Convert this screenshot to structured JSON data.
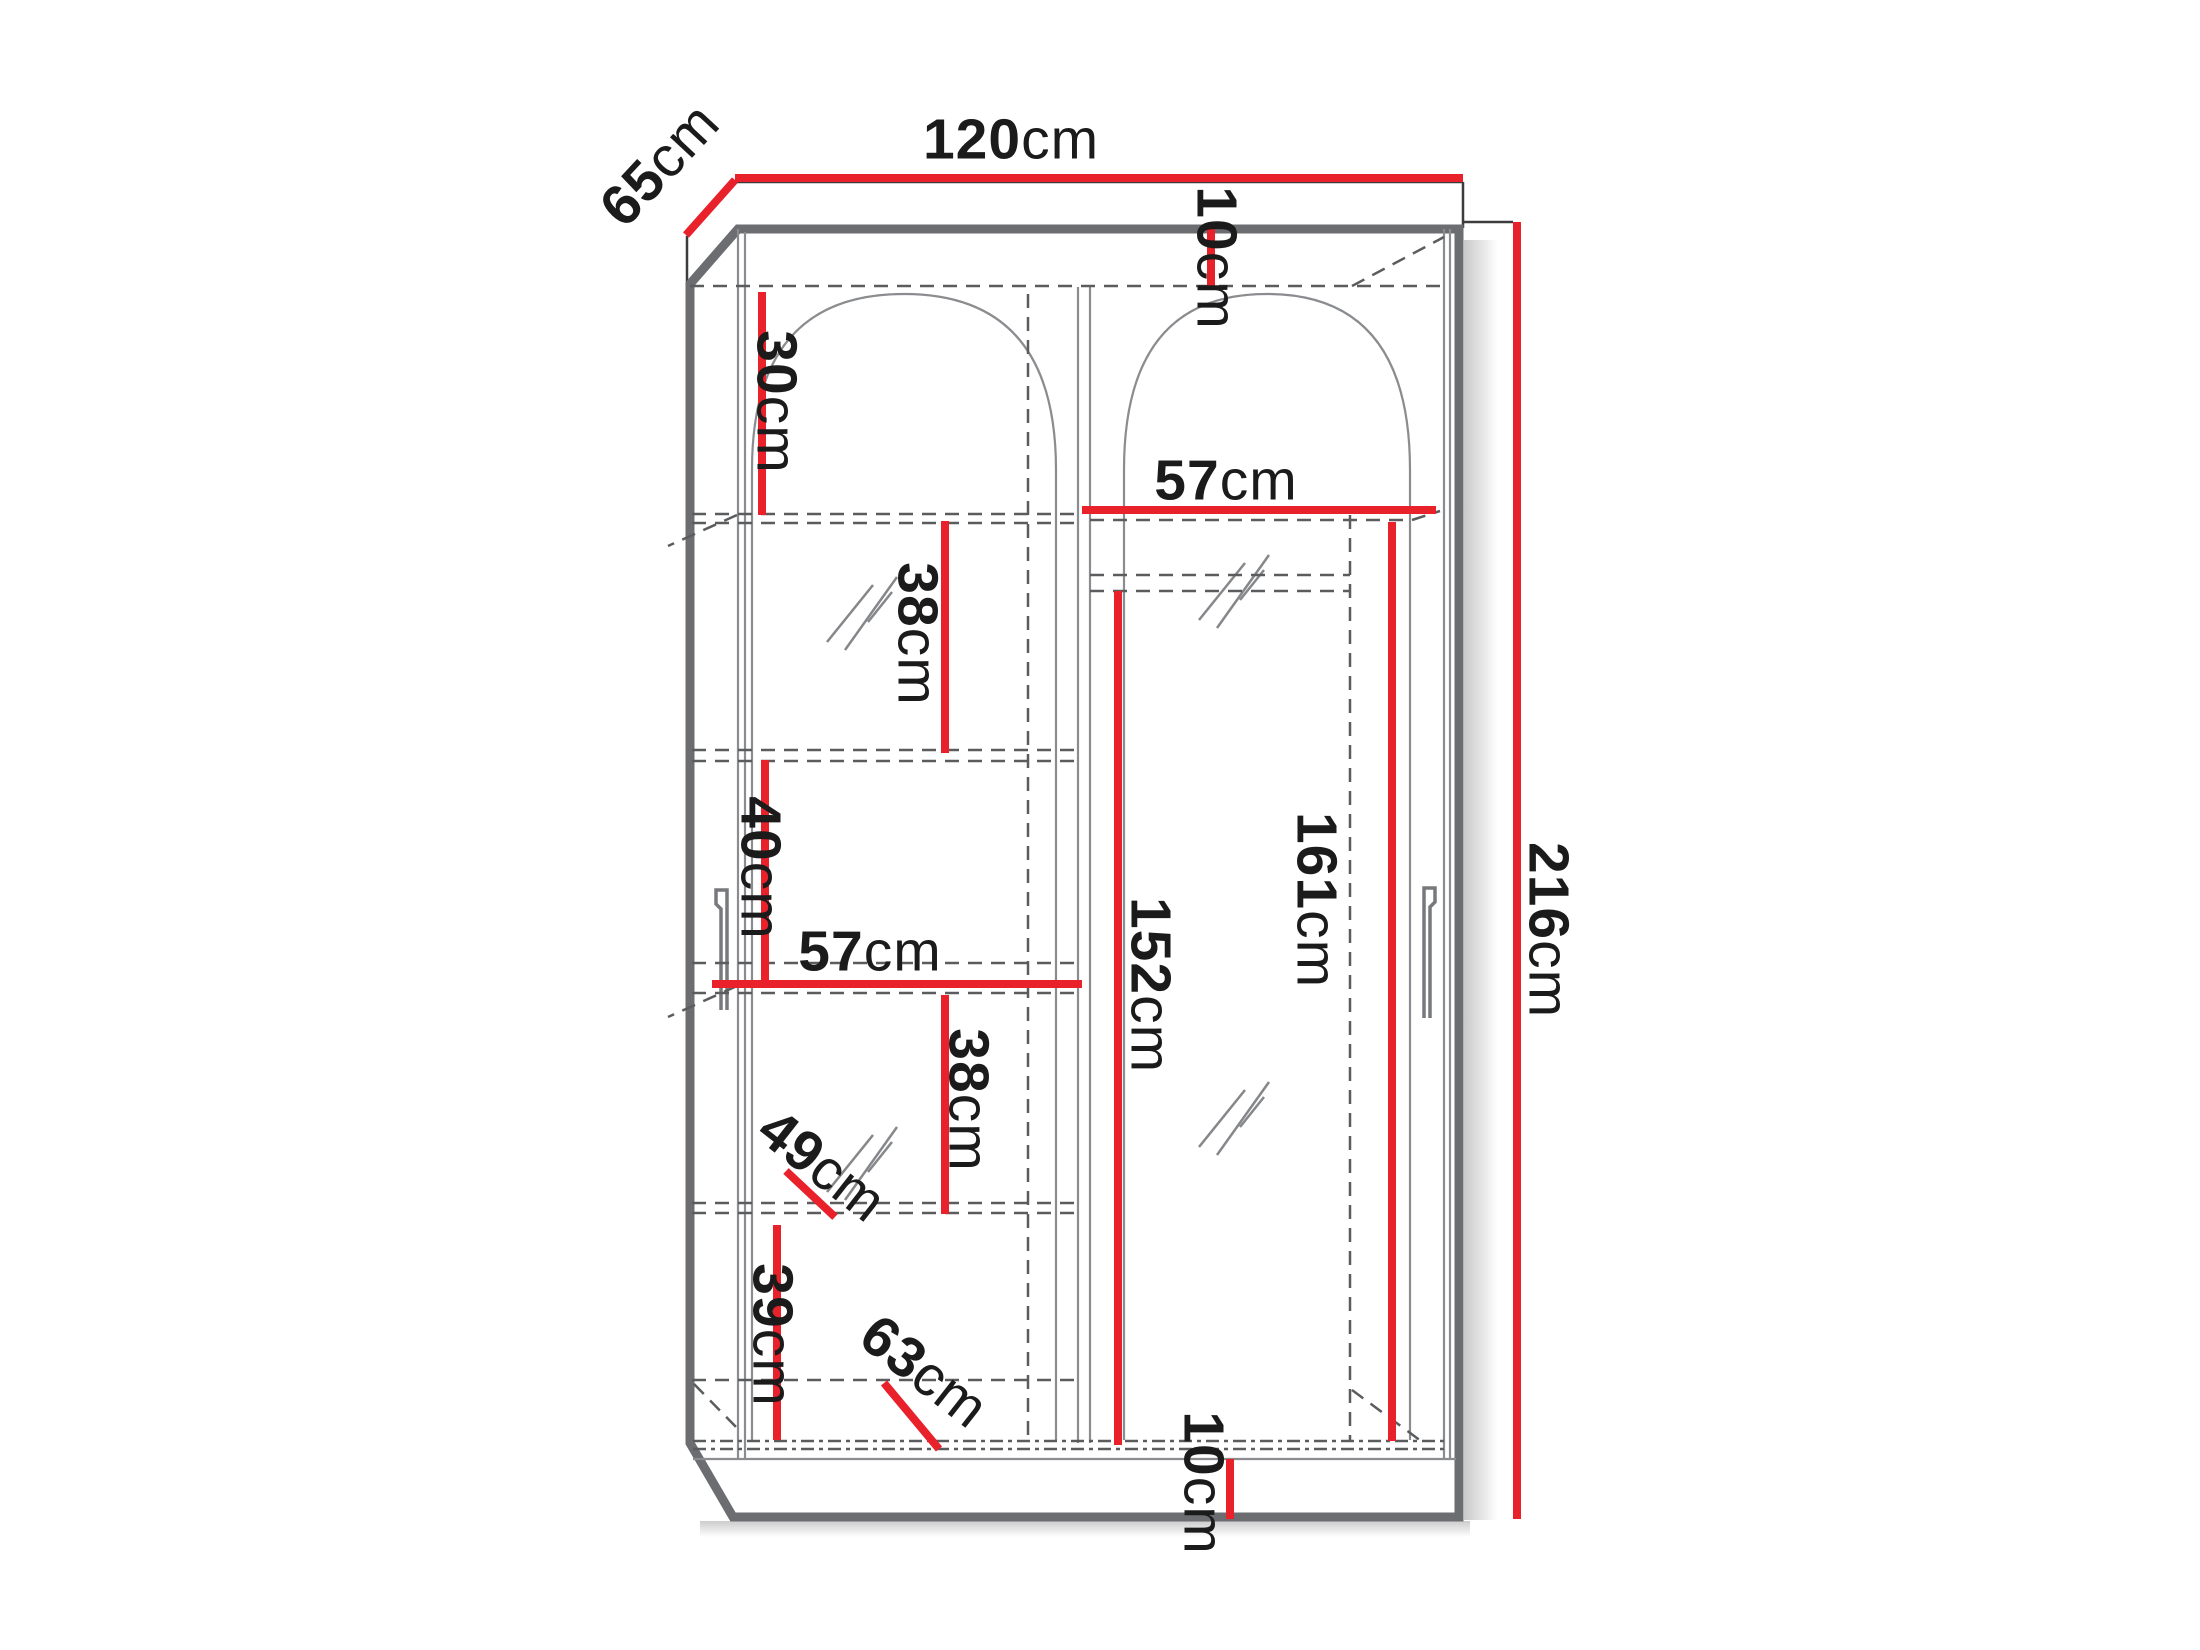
{
  "diagram": {
    "type": "furniture-dimension-drawing",
    "subject": "two-door sliding wardrobe with arched mirror doors, front view with perspective side",
    "unit": "cm"
  },
  "colors": {
    "dimension_line": "#E8212B",
    "outline_gray": "#6B6D70",
    "inner_line_gray": "#8A8C8F",
    "dashed_gray": "#5A5C5E",
    "text": "#1B1B1B",
    "background": "#FFFFFF"
  },
  "dims": {
    "width": {
      "value": "120",
      "unit": "cm"
    },
    "depth": {
      "value": "65",
      "unit": "cm"
    },
    "height": {
      "value": "216",
      "unit": "cm"
    },
    "top_gap": {
      "value": "10",
      "unit": "cm"
    },
    "left_top_shelf": {
      "value": "30",
      "unit": "cm"
    },
    "right_inner_width": {
      "value": "57",
      "unit": "cm"
    },
    "left_shelf_upper": {
      "value": "38",
      "unit": "cm"
    },
    "hang_height_right": {
      "value": "161",
      "unit": "cm"
    },
    "hang_height_left": {
      "value": "152",
      "unit": "cm"
    },
    "left_shelf_mid": {
      "value": "40",
      "unit": "cm"
    },
    "left_inner_width": {
      "value": "57",
      "unit": "cm"
    },
    "left_shelf_lower": {
      "value": "38",
      "unit": "cm"
    },
    "inner_depth_upper": {
      "value": "49",
      "unit": "cm"
    },
    "left_shelf_bottom": {
      "value": "39",
      "unit": "cm"
    },
    "inner_depth_lower": {
      "value": "63",
      "unit": "cm"
    },
    "plinth_height": {
      "value": "10",
      "unit": "cm"
    }
  }
}
